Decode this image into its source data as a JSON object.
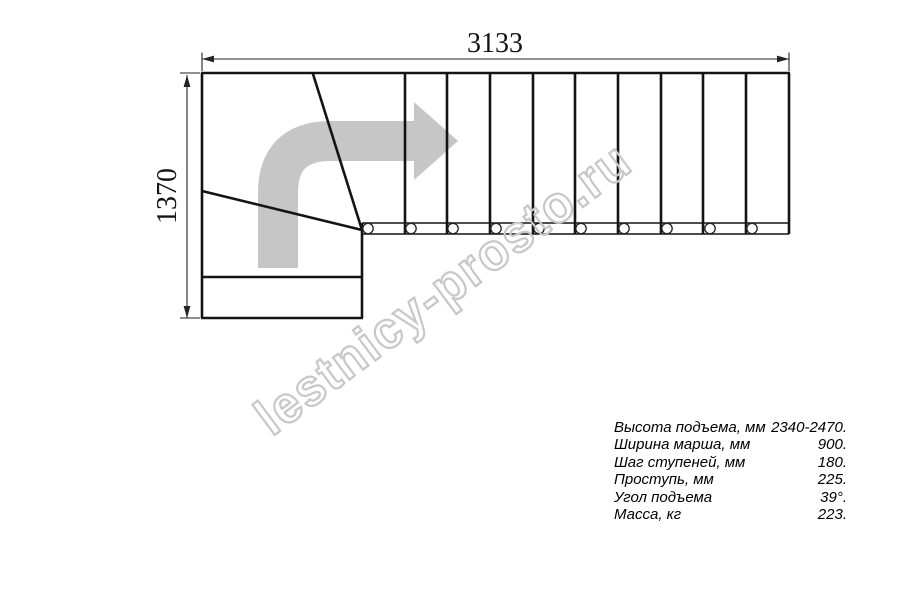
{
  "drawing": {
    "width_dimension": "3133",
    "height_dimension": "1370",
    "direction_arrow_icon": "curved-right-arrow",
    "colors": {
      "line": "#141414",
      "dimension_line": "#222222",
      "arrow_gray": "#c6c6c6",
      "watermark_gray": "#c8c8c8"
    }
  },
  "watermark": {
    "text": "lestnicy-prosto.ru"
  },
  "specs": {
    "rows": [
      {
        "label": "Высота подъема, мм",
        "value": "2340-2470."
      },
      {
        "label": "Ширина марша, мм",
        "value": "900."
      },
      {
        "label": "Шаг ступеней, мм",
        "value": "180."
      },
      {
        "label": "Проступь, мм",
        "value": "225."
      },
      {
        "label": "Угол подъема",
        "value": "39°."
      },
      {
        "label": "Масса, кг",
        "value": "223."
      }
    ]
  }
}
